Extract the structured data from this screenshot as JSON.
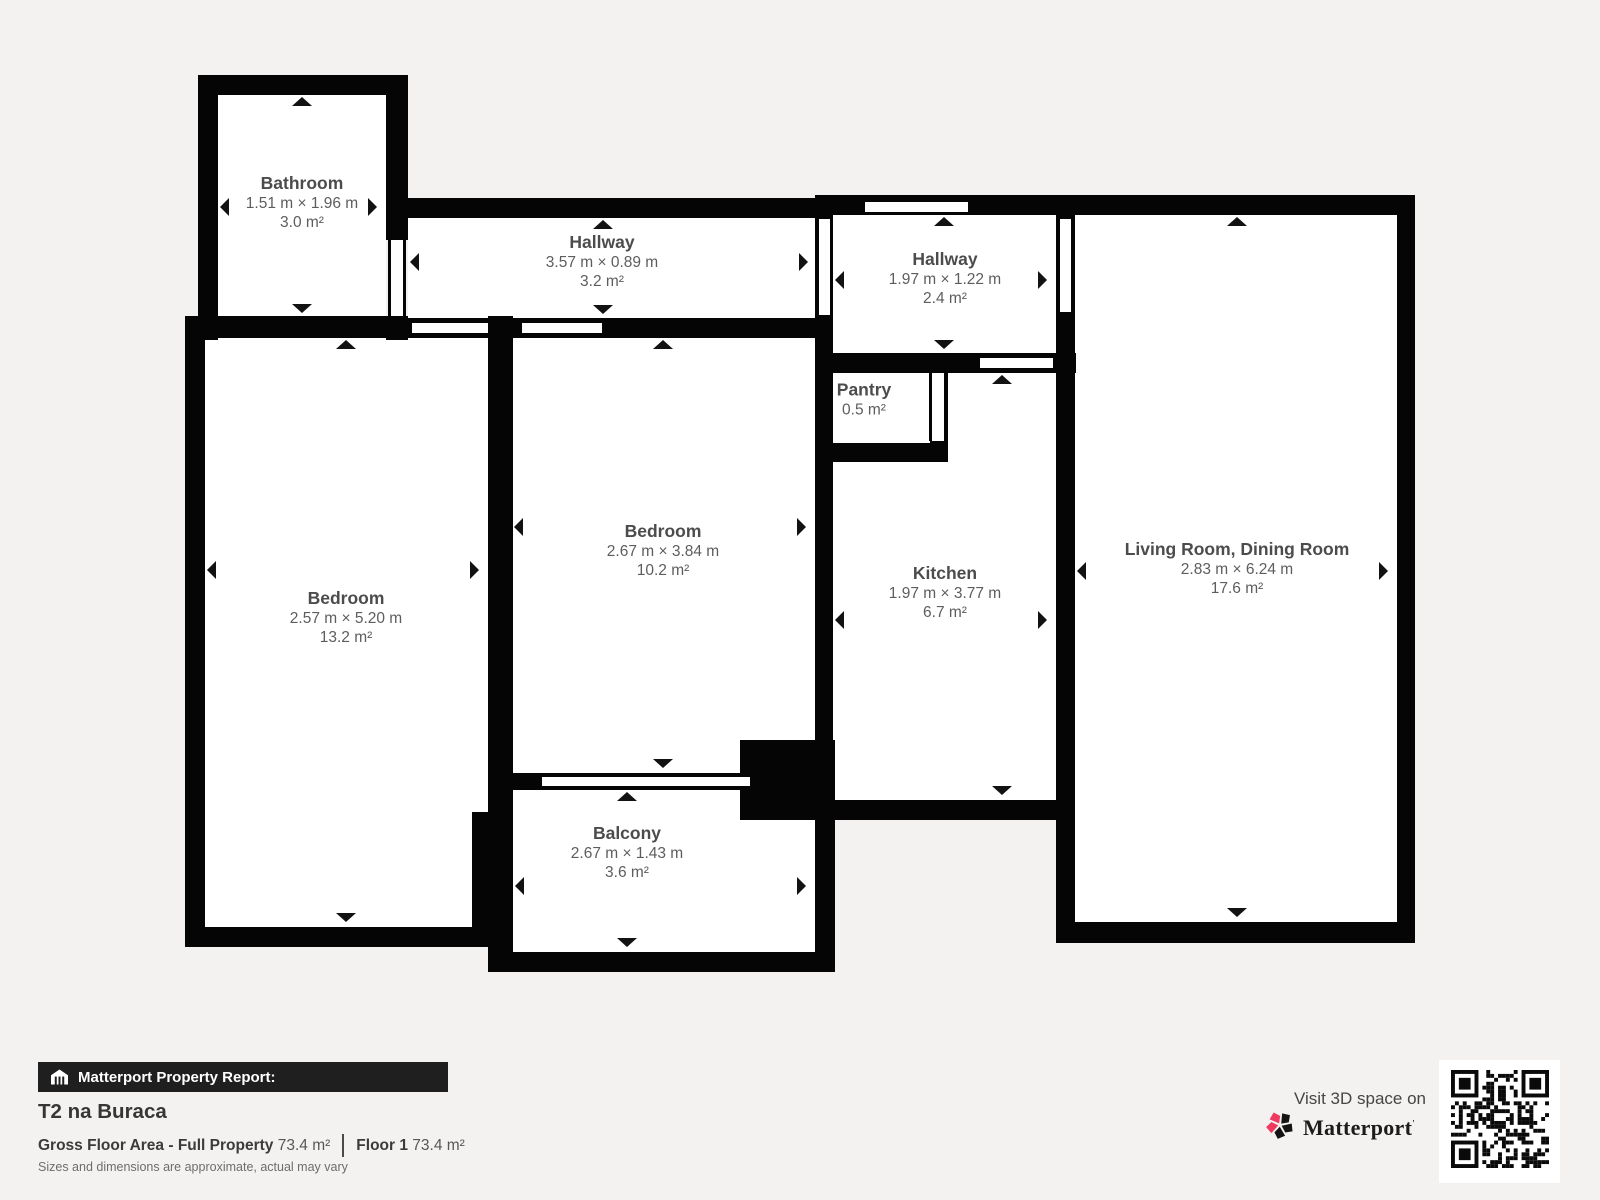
{
  "floorplan": {
    "rooms": {
      "bathroom": {
        "name": "Bathroom",
        "dims": "1.51 m × 1.96 m",
        "area": "3.0 m²"
      },
      "hallway_a": {
        "name": "Hallway",
        "dims": "3.57 m × 0.89 m",
        "area": "3.2 m²"
      },
      "hallway_b": {
        "name": "Hallway",
        "dims": "1.97 m × 1.22 m",
        "area": "2.4 m²"
      },
      "pantry": {
        "name": "Pantry",
        "area": "0.5 m²"
      },
      "bedroom_a": {
        "name": "Bedroom",
        "dims": "2.67 m × 3.84 m",
        "area": "10.2 m²"
      },
      "bedroom_b": {
        "name": "Bedroom",
        "dims": "2.57 m × 5.20 m",
        "area": "13.2 m²"
      },
      "kitchen": {
        "name": "Kitchen",
        "dims": "1.97 m × 3.77 m",
        "area": "6.7 m²"
      },
      "living": {
        "name": "Living Room, Dining Room",
        "dims": "2.83 m × 6.24 m",
        "area": "17.6 m²"
      },
      "balcony": {
        "name": "Balcony",
        "dims": "2.67 m × 1.43 m",
        "area": "3.6 m²"
      }
    }
  },
  "report": {
    "bar_label": "Matterport Property Report:",
    "property_name": "T2 na Buraca",
    "gross_area_label": "Gross Floor Area - Full Property",
    "gross_area_value": "73.4 m²",
    "floor_label": "Floor 1",
    "floor_value": "73.4 m²",
    "disclaimer": "Sizes and dimensions are approximate, actual may vary"
  },
  "promo": {
    "visit_text": "Visit 3D space on",
    "brand": "Matterport",
    "brand_mark": "'"
  },
  "icons": {
    "bar_icon": "house-icon",
    "brand_icon": "matterport-pinwheel-icon",
    "qr": "qr-code"
  },
  "colors": {
    "background": "#f4f2f0",
    "wall": "#050505",
    "room_fill": "#ffffff",
    "label_title": "#4c4c4c",
    "label_dims": "#5d5d5d",
    "bar_background": "#1f1f1f",
    "bar_text": "#ffffff",
    "brand_pink": "#ee3a5f"
  }
}
